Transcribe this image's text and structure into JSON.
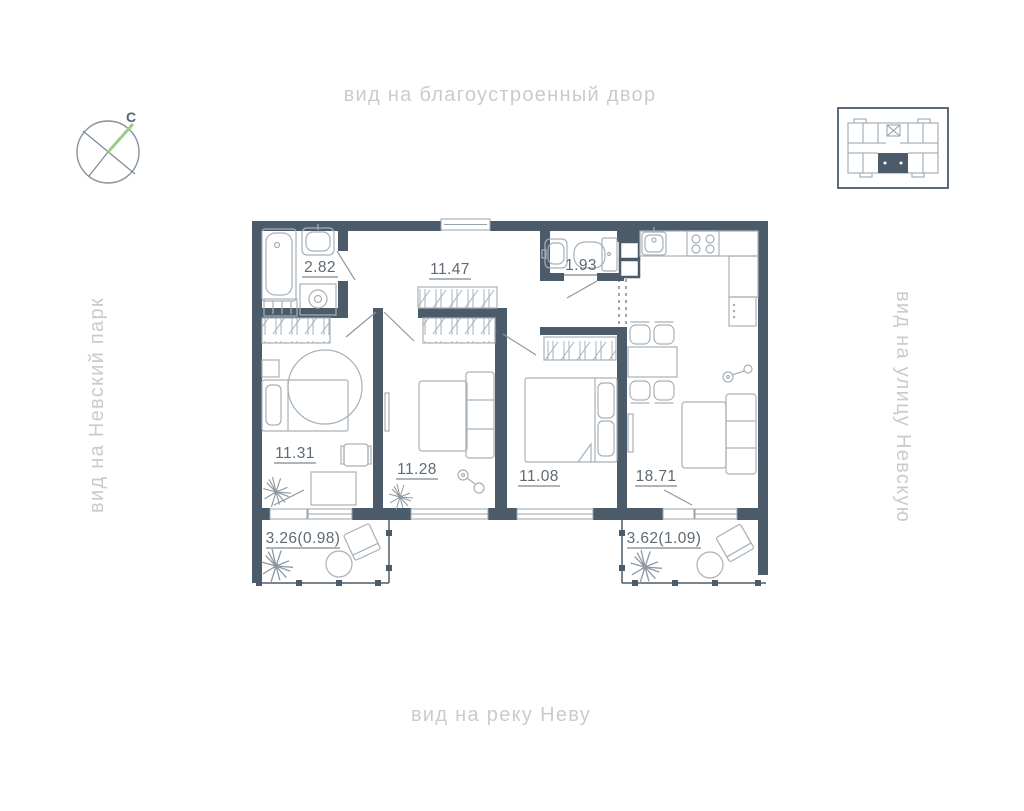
{
  "view_labels": {
    "top": "вид на благоустроенный двор",
    "bottom": "вид на реку Неву",
    "left": "вид на Невский парк",
    "right": "вид на улицу Невскую"
  },
  "compass": {
    "north_letter": "С"
  },
  "icons": {
    "compass": "compass-north-icon",
    "building_locator": "building-position-icon"
  },
  "colors": {
    "wall": "#4c5b69",
    "furniture_line": "#a6b0b8",
    "room_label": "#5f6a73",
    "view_label": "#c8cccf",
    "compass_north": "#9dcc86"
  },
  "rooms": {
    "bathroom": {
      "area": "2.82"
    },
    "hallway": {
      "area": "11.47"
    },
    "wc": {
      "area": "1.93"
    },
    "bedroom_left": {
      "area": "11.31"
    },
    "bedroom_middle": {
      "area": "11.28"
    },
    "bedroom_right": {
      "area": "11.08"
    },
    "kitchen_living": {
      "area": "18.71"
    }
  },
  "balconies": {
    "left": {
      "area": "3.26(0.98)"
    },
    "right": {
      "area": "3.62(1.09)"
    }
  }
}
